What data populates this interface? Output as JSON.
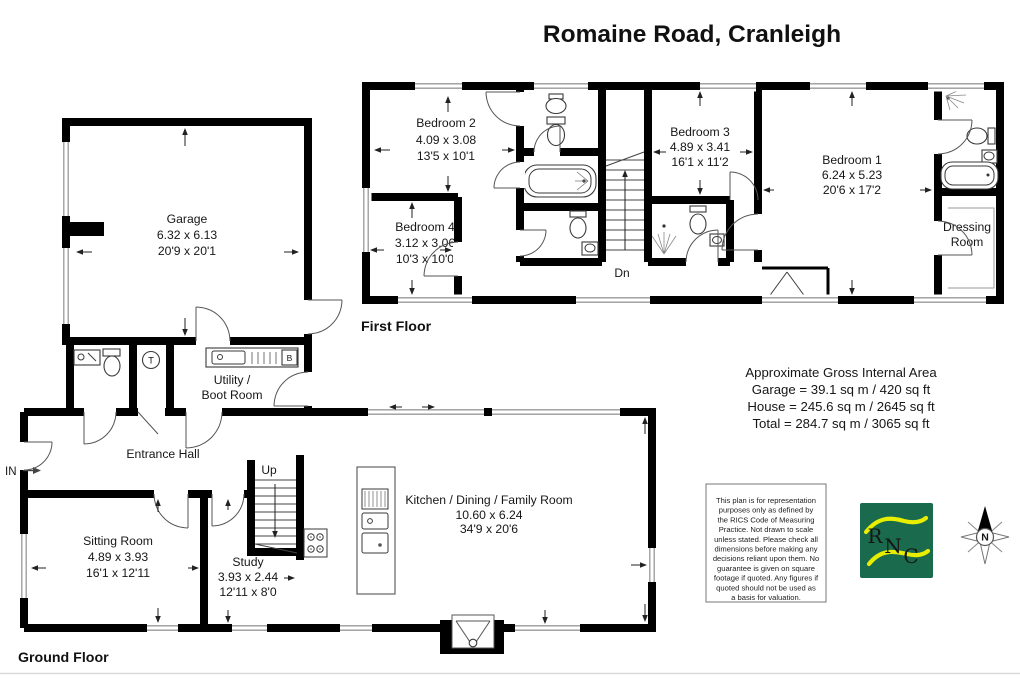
{
  "title": "Romaine Road, Cranleigh",
  "floor_labels": {
    "first": "First Floor",
    "ground": "Ground Floor"
  },
  "rooms": {
    "bedroom1": {
      "name": "Bedroom 1",
      "metric": "6.24 x 5.23",
      "imperial": "20'6 x 17'2"
    },
    "bedroom2": {
      "name": "Bedroom 2",
      "metric": "4.09 x 3.08",
      "imperial": "13'5 x 10'1"
    },
    "bedroom3": {
      "name": "Bedroom 3",
      "metric": "4.89 x 3.41",
      "imperial": "16'1 x 11'2"
    },
    "bedroom4": {
      "name": "Bedroom 4",
      "metric": "3.12 x 3.06",
      "imperial": "10'3 x 10'0"
    },
    "dressing_room": {
      "line1": "Dressing",
      "line2": "Room"
    },
    "garage": {
      "name": "Garage",
      "metric": "6.32 x 6.13",
      "imperial": "20'9 x 20'1"
    },
    "utility": {
      "line1": "Utility /",
      "line2": "Boot Room"
    },
    "entrance_hall": {
      "name": "Entrance Hall"
    },
    "sitting_room": {
      "name": "Sitting Room",
      "metric": "4.89 x 3.93",
      "imperial": "16'1 x 12'11"
    },
    "study": {
      "name": "Study",
      "metric": "3.93 x 2.44",
      "imperial": "12'11 x 8'0"
    },
    "kitchen": {
      "name": "Kitchen / Dining / Family Room",
      "metric": "10.60 x 6.24",
      "imperial": "34'9 x 20'6"
    }
  },
  "annotations": {
    "stairs_down": "Dn",
    "stairs_up": "Up",
    "entrance": "IN",
    "tank": "T",
    "boiler": "B",
    "north": "N"
  },
  "area_summary": {
    "heading": "Approximate Gross Internal Area",
    "garage": "Garage = 39.1 sq m / 420 sq ft",
    "house": "House = 245.6 sq m / 2645 sq ft",
    "total": "Total = 284.7 sq m / 3065 sq ft"
  },
  "disclaimer_lines": [
    "This plan is for representation",
    "purposes only as defined by",
    "the RICS Code of Measuring",
    "Practice. Not drawn to scale",
    "unless stated. Please check all",
    "dimensions before making any",
    "decisions reliant upon them. No",
    "guarantee is given on square",
    "footage if quoted. Any figures if",
    "quoted should not be used as",
    "a basis for valuation."
  ],
  "logo": {
    "letters": [
      "R",
      "N",
      "C"
    ]
  },
  "colors": {
    "wall": "#000000",
    "window": "#999999",
    "logo_green": "#1a6a4e",
    "logo_yellow": "#e8ee00"
  }
}
